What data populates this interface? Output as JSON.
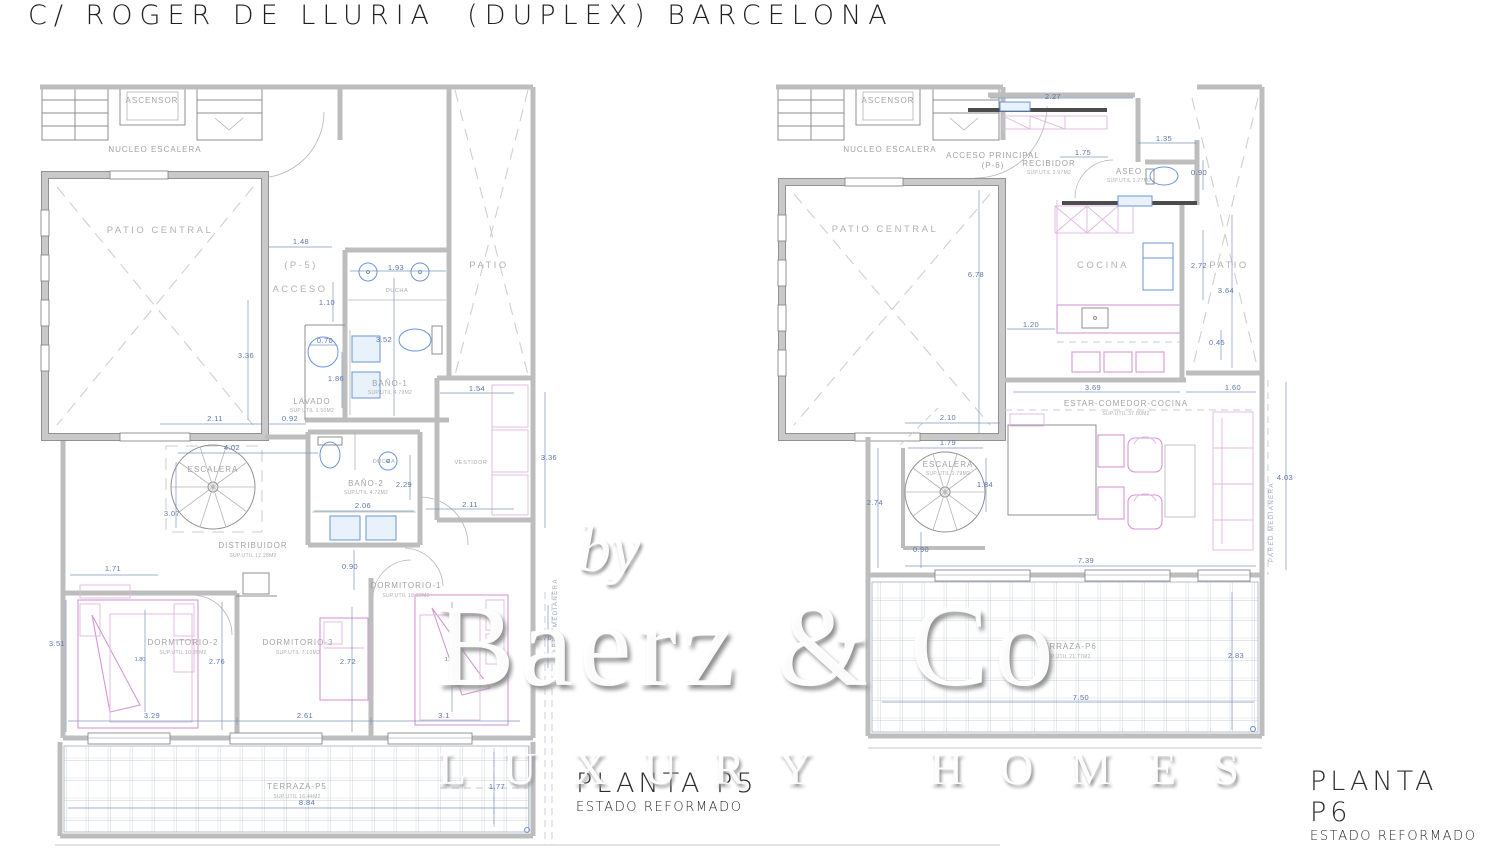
{
  "title": "C/ ROGER DE LLURIA  (DUPLEX) BARCELONA",
  "watermark": {
    "by": "by",
    "brand": "Baerz & Co",
    "tagline": "LUXURY HOMES"
  },
  "colors": {
    "wall": "#bdbdbd",
    "line": "#8f8f8f",
    "dimension": "#5e77ad",
    "room_label": "#a3a3a3",
    "furniture": "#d597d5",
    "fixture": "#6b95d6",
    "tile_grid": "#b9c3d2",
    "title_text": "#1f1f1f"
  },
  "symbols": [
    "spiral-staircase",
    "toilet",
    "shower",
    "washbasin",
    "bathtub-sink",
    "bed",
    "sofa",
    "armchair",
    "dining-table",
    "kitchen-island",
    "refrigerator",
    "door-swing",
    "tiled-terrace"
  ],
  "plans": {
    "p5": {
      "label": "PLANTA P5",
      "sublabel": "ESTADO REFORMADO",
      "room_labels": [
        {
          "x": 152,
          "y": 103,
          "t": "ASCENSOR",
          "c": "room"
        },
        {
          "x": 155,
          "y": 152,
          "t": "NUCLEO ESCALERA",
          "c": "room"
        },
        {
          "x": 160,
          "y": 233,
          "t": "PATIO CENTRAL",
          "c": "roomlg"
        },
        {
          "x": 301,
          "y": 268,
          "t": "(P-5)",
          "c": "roomlg"
        },
        {
          "x": 300,
          "y": 292,
          "t": "ACCESO",
          "c": "roomlg"
        },
        {
          "x": 489,
          "y": 268,
          "t": "PATIO",
          "c": "roomlg"
        },
        {
          "x": 397,
          "y": 292,
          "t": "DUCHA",
          "c": "tiny"
        },
        {
          "x": 390,
          "y": 386,
          "t": "BAÑO-1",
          "c": "room"
        },
        {
          "x": 390,
          "y": 394,
          "t": "SUP.UTIL 4.79M2",
          "c": "sup"
        },
        {
          "x": 312,
          "y": 404,
          "t": "LAVADO",
          "c": "room"
        },
        {
          "x": 312,
          "y": 412,
          "t": "SUP.UTIL 1.50M2",
          "c": "sup"
        },
        {
          "x": 213,
          "y": 472,
          "t": "ESCALERA",
          "c": "room"
        },
        {
          "x": 384,
          "y": 463,
          "t": "DUCHA",
          "c": "tiny"
        },
        {
          "x": 366,
          "y": 486,
          "t": "BAÑO-2",
          "c": "room"
        },
        {
          "x": 366,
          "y": 494,
          "t": "SUP.UTIL 4.72M2",
          "c": "sup"
        },
        {
          "x": 471,
          "y": 464,
          "t": "VESTIDOR",
          "c": "tiny"
        },
        {
          "x": 253,
          "y": 548,
          "t": "DISTRIBUIDOR",
          "c": "room"
        },
        {
          "x": 253,
          "y": 557,
          "t": "SUP.UTIL 12.28M2",
          "c": "sup"
        },
        {
          "x": 406,
          "y": 588,
          "t": "DORMITORIO-1",
          "c": "room"
        },
        {
          "x": 406,
          "y": 597,
          "t": "SUP.UTIL 18.22M2",
          "c": "sup"
        },
        {
          "x": 183,
          "y": 645,
          "t": "DORMITORIO-2",
          "c": "room"
        },
        {
          "x": 183,
          "y": 654,
          "t": "SUP.UTIL 10.35M2",
          "c": "sup"
        },
        {
          "x": 298,
          "y": 645,
          "t": "DORMITORIO-3",
          "c": "room"
        },
        {
          "x": 298,
          "y": 654,
          "t": "SUP.UTIL 7.10M2",
          "c": "sup"
        },
        {
          "x": 297,
          "y": 789,
          "t": "TERRAZA-P5",
          "c": "room"
        },
        {
          "x": 297,
          "y": 798,
          "t": "SUP.UTIL 16.44M2",
          "c": "sup"
        },
        {
          "x": 557,
          "y": 618,
          "t": "PARED MEDIANERA",
          "c": "vtext",
          "r": -90
        }
      ],
      "dim_labels": [
        {
          "x": 301,
          "y": 244,
          "t": "1.48"
        },
        {
          "x": 396,
          "y": 270,
          "t": "1.93"
        },
        {
          "x": 327,
          "y": 305,
          "t": "1.10"
        },
        {
          "x": 325,
          "y": 343,
          "t": "0.70"
        },
        {
          "x": 384,
          "y": 342,
          "t": "3.52"
        },
        {
          "x": 336,
          "y": 381,
          "t": "1.86"
        },
        {
          "x": 246,
          "y": 358,
          "t": "3.36"
        },
        {
          "x": 215,
          "y": 421,
          "t": "2.11"
        },
        {
          "x": 290,
          "y": 421,
          "t": "0.92"
        },
        {
          "x": 232,
          "y": 450,
          "t": "4.02"
        },
        {
          "x": 172,
          "y": 516,
          "t": "3.07"
        },
        {
          "x": 404,
          "y": 487,
          "t": "2.29"
        },
        {
          "x": 363,
          "y": 508,
          "t": "2.06"
        },
        {
          "x": 350,
          "y": 569,
          "t": "0.90"
        },
        {
          "x": 477,
          "y": 391,
          "t": "1.54"
        },
        {
          "x": 549,
          "y": 460,
          "t": "3.36"
        },
        {
          "x": 470,
          "y": 507,
          "t": "2.11"
        },
        {
          "x": 113,
          "y": 571,
          "t": "1.71"
        },
        {
          "x": 57,
          "y": 646,
          "t": "3.51"
        },
        {
          "x": 140,
          "y": 661,
          "t": "1.80",
          "c": "dimsm"
        },
        {
          "x": 217,
          "y": 664,
          "t": "2.76"
        },
        {
          "x": 348,
          "y": 664,
          "t": "2.72"
        },
        {
          "x": 450,
          "y": 661,
          "t": "1.80",
          "c": "dimsm"
        },
        {
          "x": 152,
          "y": 718,
          "t": "3.29"
        },
        {
          "x": 305,
          "y": 718,
          "t": "2.61"
        },
        {
          "x": 444,
          "y": 718,
          "t": "3.1"
        },
        {
          "x": 307,
          "y": 805,
          "t": "8.84"
        },
        {
          "x": 497,
          "y": 789,
          "t": "1.77"
        },
        {
          "x": 544,
          "y": 640,
          "t": "1.76"
        }
      ]
    },
    "p6": {
      "label": "PLANTA P6",
      "sublabel": "ESTADO REFORMADO",
      "room_labels": [
        {
          "x": 888,
          "y": 103,
          "t": "ASCENSOR",
          "c": "room"
        },
        {
          "x": 890,
          "y": 152,
          "t": "NUCLEO ESCALERA",
          "c": "room"
        },
        {
          "x": 993,
          "y": 158,
          "t": "ACCESO PRINCIPAL",
          "c": "room"
        },
        {
          "x": 993,
          "y": 168,
          "t": "(P-6)",
          "c": "room"
        },
        {
          "x": 1049,
          "y": 166,
          "t": "RECIBIDOR",
          "c": "room"
        },
        {
          "x": 1049,
          "y": 174,
          "t": "SUP.UTIL 2.97M2",
          "c": "sup"
        },
        {
          "x": 1129,
          "y": 174,
          "t": "ASEO",
          "c": "room"
        },
        {
          "x": 1129,
          "y": 182,
          "t": "SUP.UTIL 1.27M2",
          "c": "sup"
        },
        {
          "x": 885,
          "y": 232,
          "t": "PATIO CENTRAL",
          "c": "roomlg"
        },
        {
          "x": 1103,
          "y": 268,
          "t": "COCINA",
          "c": "roomlg"
        },
        {
          "x": 1229,
          "y": 268,
          "t": "PATIO",
          "c": "roomlg"
        },
        {
          "x": 1126,
          "y": 406,
          "t": "ESTAR-COMEDOR-COCINA",
          "c": "room"
        },
        {
          "x": 1126,
          "y": 415,
          "t": "SUP.UTIL 37.80M2",
          "c": "sup"
        },
        {
          "x": 948,
          "y": 467,
          "t": "ESCALERA",
          "c": "room"
        },
        {
          "x": 948,
          "y": 475,
          "t": "SUP.UTIL 1.79M2",
          "c": "sup"
        },
        {
          "x": 1067,
          "y": 649,
          "t": "TERRAZA-P6",
          "c": "room"
        },
        {
          "x": 1067,
          "y": 658,
          "t": "SUP.UTIL 21.77M2",
          "c": "sup"
        },
        {
          "x": 1273,
          "y": 522,
          "t": "PARED MEDIANERA",
          "c": "vtext",
          "r": -90
        }
      ],
      "dim_labels": [
        {
          "x": 1053,
          "y": 99,
          "t": "2.27"
        },
        {
          "x": 1164,
          "y": 141,
          "t": "1.35"
        },
        {
          "x": 1083,
          "y": 155,
          "t": "1.75"
        },
        {
          "x": 1199,
          "y": 175,
          "t": "0.90"
        },
        {
          "x": 976,
          "y": 277,
          "t": "6.78"
        },
        {
          "x": 1199,
          "y": 268,
          "t": "2.72"
        },
        {
          "x": 1226,
          "y": 293,
          "t": "3.64"
        },
        {
          "x": 1031,
          "y": 327,
          "t": "1.20"
        },
        {
          "x": 1217,
          "y": 345,
          "t": "0.45"
        },
        {
          "x": 1093,
          "y": 390,
          "t": "3.69"
        },
        {
          "x": 1233,
          "y": 390,
          "t": "1.60"
        },
        {
          "x": 948,
          "y": 420,
          "t": "2.10"
        },
        {
          "x": 948,
          "y": 445,
          "t": "1.79"
        },
        {
          "x": 985,
          "y": 487,
          "t": "1.84"
        },
        {
          "x": 875,
          "y": 505,
          "t": "2.74"
        },
        {
          "x": 921,
          "y": 552,
          "t": "0.90"
        },
        {
          "x": 1086,
          "y": 563,
          "t": "7.39"
        },
        {
          "x": 1285,
          "y": 480,
          "t": "4.03"
        },
        {
          "x": 1236,
          "y": 658,
          "t": "2.83"
        },
        {
          "x": 1081,
          "y": 700,
          "t": "7.50"
        }
      ]
    }
  }
}
